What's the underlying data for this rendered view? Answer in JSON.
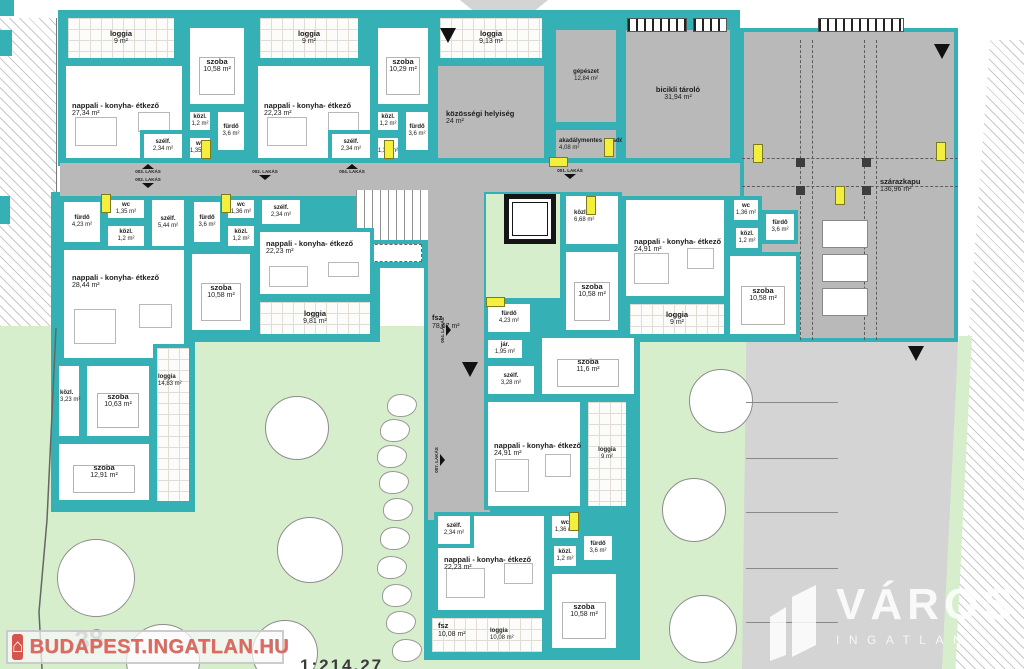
{
  "palette": {
    "teal": "#35b0b4",
    "room_gray": "#b9b9b9",
    "outdoor_gray": "#d4d4d4",
    "green": "#d6eecb",
    "door_yellow": "#f4ef3c",
    "watermark_red": "#df695f"
  },
  "watermark_left": {
    "text": "BUDAPEST.INGATLAN.HU",
    "house_icon": "⌂"
  },
  "watermark_right": {
    "text": "VÁROS",
    "subtext": "INGATLAN"
  },
  "plot_number": "38",
  "scale_fragment": "1:214.27",
  "corridor_label": {
    "name": "fsz",
    "area": "78,67 m²"
  },
  "rooms": [
    {
      "n": "loggia",
      "a": "9 m²",
      "x": 64,
      "y": 14,
      "w": 114,
      "h": 48,
      "f": "t"
    },
    {
      "n": "nappali - konyha- étkező",
      "a": "27,34 m²",
      "x": 62,
      "y": 62,
      "w": 124,
      "h": 100,
      "f": "w",
      "lx": 6,
      "ly": 36,
      "fn": "nappali"
    },
    {
      "n": "szoba",
      "a": "10,58 m²",
      "x": 186,
      "y": 24,
      "w": 62,
      "h": 84,
      "f": "w",
      "fn": "szoba"
    },
    {
      "n": "közl.",
      "a": "1,2 m²",
      "x": 186,
      "y": 108,
      "w": 28,
      "h": 26,
      "f": "w",
      "s": 1
    },
    {
      "n": "fürdő",
      "a": "3,6 m²",
      "x": 214,
      "y": 108,
      "w": 34,
      "h": 46,
      "f": "w",
      "s": 1
    },
    {
      "n": "szélf.",
      "a": "2,34 m²",
      "x": 140,
      "y": 130,
      "w": 46,
      "h": 32,
      "f": "w",
      "s": 1
    },
    {
      "n": "wc",
      "a": "1,35 m²",
      "x": 186,
      "y": 134,
      "w": 28,
      "h": 28,
      "f": "w",
      "s": 1
    },
    {
      "n": "loggia",
      "a": "9 m²",
      "x": 256,
      "y": 14,
      "w": 106,
      "h": 48,
      "f": "t"
    },
    {
      "n": "nappali - konyha- étkező",
      "a": "22,23 m²",
      "x": 254,
      "y": 62,
      "w": 120,
      "h": 100,
      "f": "w",
      "lx": 6,
      "ly": 36,
      "fn": "nappali"
    },
    {
      "n": "szoba",
      "a": "10,29 m²",
      "x": 374,
      "y": 24,
      "w": 58,
      "h": 84,
      "f": "w",
      "fn": "szoba"
    },
    {
      "n": "közl.",
      "a": "1,2 m²",
      "x": 374,
      "y": 108,
      "w": 28,
      "h": 26,
      "f": "w",
      "s": 1
    },
    {
      "n": "fürdő",
      "a": "3,6 m²",
      "x": 402,
      "y": 108,
      "w": 30,
      "h": 46,
      "f": "w",
      "s": 1
    },
    {
      "n": "szélf.",
      "a": "2,34 m²",
      "x": 328,
      "y": 130,
      "w": 46,
      "h": 32,
      "f": "w",
      "s": 1
    },
    {
      "n": "wc",
      "a": "1,35 m²",
      "x": 374,
      "y": 134,
      "w": 28,
      "h": 28,
      "f": "w",
      "s": 1
    },
    {
      "n": "loggia",
      "a": "9,13 m²",
      "x": 436,
      "y": 14,
      "w": 110,
      "h": 48,
      "f": "t"
    },
    {
      "n": "közösségi helyiség",
      "a": "24 m²",
      "x": 434,
      "y": 62,
      "w": 114,
      "h": 100,
      "f": "g",
      "lx": 8,
      "ly": 44
    },
    {
      "n": "gépészet",
      "a": "12,84 m²",
      "x": 552,
      "y": 26,
      "w": 68,
      "h": 100,
      "f": "g",
      "s": 1
    },
    {
      "n": "akadálymentes mosdó",
      "a": "4,08 m²",
      "x": 552,
      "y": 126,
      "w": 68,
      "h": 36,
      "f": "g",
      "s": 1,
      "lx": 3,
      "ly": 8
    },
    {
      "n": "bicikli tároló",
      "a": "31,94 m²",
      "x": 622,
      "y": 26,
      "w": 112,
      "h": 136,
      "f": "g"
    },
    {
      "n": "szárazkapu",
      "a": "136,96 m²",
      "x": 740,
      "y": 28,
      "w": 218,
      "h": 314,
      "f": "g",
      "lx": 136,
      "ly": 146
    },
    {
      "n": "fürdő",
      "a": "4,23 m²",
      "x": 60,
      "y": 198,
      "w": 44,
      "h": 48,
      "f": "w",
      "s": 1
    },
    {
      "n": "wc",
      "a": "1,35 m²",
      "x": 104,
      "y": 196,
      "w": 44,
      "h": 26,
      "f": "w",
      "s": 1
    },
    {
      "n": "közl.",
      "a": "1,2 m²",
      "x": 104,
      "y": 222,
      "w": 44,
      "h": 28,
      "f": "w",
      "s": 1
    },
    {
      "n": "szélf.",
      "a": "5,44 m²",
      "x": 148,
      "y": 196,
      "w": 40,
      "h": 54,
      "f": "w",
      "s": 1
    },
    {
      "n": "nappali - konyha- étkező",
      "a": "28,44 m²",
      "x": 60,
      "y": 246,
      "w": 128,
      "h": 116,
      "f": "w",
      "lx": 8,
      "ly": 24,
      "fn": "nappali"
    },
    {
      "n": "közl.",
      "a": "3,23 m²",
      "x": 55,
      "y": 362,
      "w": 28,
      "h": 78,
      "f": "w",
      "s": 1,
      "lx": 1,
      "ly": 24
    },
    {
      "n": "szoba",
      "a": "10,63 m²",
      "x": 83,
      "y": 362,
      "w": 70,
      "h": 78,
      "f": "w",
      "fn": "szoba"
    },
    {
      "n": "loggia",
      "a": "14,83 m²",
      "x": 153,
      "y": 344,
      "w": 40,
      "h": 161,
      "f": "t",
      "s": 1,
      "lx": 1,
      "ly": 26
    },
    {
      "n": "szoba",
      "a": "12,91 m²",
      "x": 55,
      "y": 440,
      "w": 98,
      "h": 64,
      "f": "w",
      "fn": "szoba"
    },
    {
      "n": "fürdő",
      "a": "3,6 m²",
      "x": 190,
      "y": 198,
      "w": 34,
      "h": 48,
      "f": "w",
      "s": 1
    },
    {
      "n": "wc",
      "a": "1,36 m²",
      "x": 224,
      "y": 196,
      "w": 34,
      "h": 26,
      "f": "w",
      "s": 1
    },
    {
      "n": "közl.",
      "a": "1,2 m²",
      "x": 224,
      "y": 222,
      "w": 34,
      "h": 28,
      "f": "w",
      "s": 1
    },
    {
      "n": "szélf.",
      "a": "2,34 m²",
      "x": 258,
      "y": 196,
      "w": 46,
      "h": 32,
      "f": "w",
      "s": 1
    },
    {
      "n": "nappali - konyha- étkező",
      "a": "22,23 m²",
      "x": 256,
      "y": 228,
      "w": 118,
      "h": 70,
      "f": "w",
      "lx": 6,
      "ly": 8,
      "fn": "nappali"
    },
    {
      "n": "szoba",
      "a": "10,58 m²",
      "x": 188,
      "y": 250,
      "w": 66,
      "h": 84,
      "f": "w",
      "fn": "szoba"
    },
    {
      "n": "loggia",
      "a": "9,81 m²",
      "x": 256,
      "y": 298,
      "w": 118,
      "h": 40,
      "f": "t"
    },
    {
      "n": "közl.",
      "a": "6,68 m²",
      "x": 562,
      "y": 192,
      "w": 60,
      "h": 56,
      "f": "w",
      "s": 1,
      "lx": 8,
      "ly": 14
    },
    {
      "n": "szoba",
      "a": "10,58 m²",
      "x": 562,
      "y": 248,
      "w": 60,
      "h": 86,
      "f": "w",
      "fn": "szoba"
    },
    {
      "n": "fürdő",
      "a": "4,23 m²",
      "x": 484,
      "y": 300,
      "w": 50,
      "h": 36,
      "f": "w",
      "s": 1
    },
    {
      "n": "jár.",
      "a": "1,95 m²",
      "x": 484,
      "y": 336,
      "w": 42,
      "h": 26,
      "f": "w",
      "s": 1
    },
    {
      "n": "szélf.",
      "a": "3,28 m²",
      "x": 484,
      "y": 362,
      "w": 54,
      "h": 36,
      "f": "w",
      "s": 1
    },
    {
      "n": "szoba",
      "a": "11,6 m²",
      "x": 538,
      "y": 334,
      "w": 100,
      "h": 64,
      "f": "w",
      "fn": "szoba"
    },
    {
      "n": "nappali - konyha- étkező",
      "a": "24,91 m²",
      "x": 484,
      "y": 398,
      "w": 100,
      "h": 112,
      "f": "w",
      "lx": 6,
      "ly": 40,
      "fn": "nappali"
    },
    {
      "n": "loggia",
      "a": "9 m²",
      "x": 584,
      "y": 398,
      "w": 46,
      "h": 112,
      "f": "t",
      "s": 1
    },
    {
      "n": "nappali - konyha- étkező",
      "a": "24,91 m²",
      "x": 622,
      "y": 196,
      "w": 106,
      "h": 104,
      "f": "w",
      "lx": 8,
      "ly": 38,
      "fn": "nappali"
    },
    {
      "n": "loggia",
      "a": "9 m²",
      "x": 626,
      "y": 300,
      "w": 102,
      "h": 38,
      "f": "t"
    },
    {
      "n": "wc",
      "a": "1,36 m²",
      "x": 730,
      "y": 196,
      "w": 32,
      "h": 28,
      "f": "w",
      "s": 1
    },
    {
      "n": "fürdő",
      "a": "3,6 m²",
      "x": 762,
      "y": 210,
      "w": 36,
      "h": 34,
      "f": "w",
      "s": 1
    },
    {
      "n": "közl.",
      "a": "1,2 m²",
      "x": 732,
      "y": 224,
      "w": 30,
      "h": 28,
      "f": "w",
      "s": 1
    },
    {
      "n": "szoba",
      "a": "10,58 m²",
      "x": 726,
      "y": 252,
      "w": 74,
      "h": 86,
      "f": "w",
      "fn": "szoba"
    },
    {
      "n": "nappali - konyha- étkező",
      "a": "22,23 m²",
      "x": 434,
      "y": 512,
      "w": 114,
      "h": 102,
      "f": "w",
      "lx": 6,
      "ly": 40,
      "fn": "nappali"
    },
    {
      "n": "szélf.",
      "a": "2,34 m²",
      "x": 434,
      "y": 512,
      "w": 40,
      "h": 36,
      "f": "w",
      "s": 1
    },
    {
      "n": "wc",
      "a": "1,36 m²",
      "x": 548,
      "y": 512,
      "w": 34,
      "h": 30,
      "f": "w",
      "s": 1
    },
    {
      "n": "fürdő",
      "a": "3,6 m²",
      "x": 580,
      "y": 532,
      "w": 36,
      "h": 32,
      "f": "w",
      "s": 1
    },
    {
      "n": "közl.",
      "a": "1,2 m²",
      "x": 550,
      "y": 542,
      "w": 30,
      "h": 28,
      "f": "w",
      "s": 1
    },
    {
      "n": "szoba",
      "a": "10,58 m²",
      "x": 548,
      "y": 570,
      "w": 72,
      "h": 82,
      "f": "w",
      "fn": "szoba"
    },
    {
      "n": "loggia",
      "a": "10,08 m²",
      "x": 428,
      "y": 614,
      "w": 118,
      "h": 42,
      "f": "t",
      "s": 1,
      "lx": 58,
      "ly": 10
    }
  ],
  "annotations": [
    {
      "name": "fsz",
      "area": "78,67 m²",
      "x": 432,
      "y": 314
    },
    {
      "name": "fsz",
      "area": "10,08 m²",
      "x": 438,
      "y": 622
    }
  ],
  "lakas_markers": [
    {
      "x": 126,
      "y": 164,
      "label": "003. LAKÁS",
      "dir": "up"
    },
    {
      "x": 126,
      "y": 177,
      "label": "002. LAKÁS",
      "dir": "down"
    },
    {
      "x": 243,
      "y": 169,
      "label": "002. LAKÁS",
      "dir": "down"
    },
    {
      "x": 330,
      "y": 164,
      "label": "004. LAKÁS",
      "dir": "up"
    },
    {
      "x": 548,
      "y": 168,
      "label": "001. LAKÁS",
      "dir": "down"
    },
    {
      "x": 440,
      "y": 352,
      "label": "004. LAKÁS",
      "dir": "down",
      "rot": 1
    },
    {
      "x": 434,
      "y": 482,
      "label": "007. LAKÁS",
      "dir": "down",
      "rot": 1
    }
  ],
  "big_arrows": [
    {
      "x": 440,
      "y": 28
    },
    {
      "x": 934,
      "y": 44
    },
    {
      "x": 908,
      "y": 346
    },
    {
      "x": 462,
      "y": 362
    }
  ],
  "door_markers": [
    {
      "x": 201,
      "y": 140,
      "o": "v"
    },
    {
      "x": 384,
      "y": 140,
      "o": "v"
    },
    {
      "x": 604,
      "y": 138,
      "o": "v"
    },
    {
      "x": 549,
      "y": 157,
      "o": "h"
    },
    {
      "x": 101,
      "y": 194,
      "o": "v"
    },
    {
      "x": 221,
      "y": 194,
      "o": "v"
    },
    {
      "x": 586,
      "y": 196,
      "o": "v"
    },
    {
      "x": 486,
      "y": 297,
      "o": "h"
    },
    {
      "x": 569,
      "y": 512,
      "o": "v"
    },
    {
      "x": 753,
      "y": 144,
      "o": "v"
    },
    {
      "x": 936,
      "y": 142,
      "o": "v"
    },
    {
      "x": 835,
      "y": 186,
      "o": "v"
    }
  ],
  "trees": [
    [
      296,
      427,
      31
    ],
    [
      309,
      549,
      32
    ],
    [
      95,
      577,
      38
    ],
    [
      162,
      660,
      36
    ],
    [
      284,
      652,
      32
    ],
    [
      720,
      400,
      31
    ],
    [
      693,
      509,
      31
    ],
    [
      702,
      628,
      33
    ]
  ],
  "stones": [
    [
      401,
      404
    ],
    [
      394,
      429
    ],
    [
      391,
      455
    ],
    [
      393,
      481
    ],
    [
      397,
      508
    ],
    [
      394,
      537
    ],
    [
      391,
      566
    ],
    [
      396,
      594
    ],
    [
      400,
      621
    ],
    [
      406,
      649
    ]
  ],
  "parking_lines": [
    402,
    458,
    512,
    568,
    622
  ],
  "parking_stalls": [
    [
      822,
      220
    ],
    [
      822,
      254
    ],
    [
      822,
      288
    ]
  ]
}
